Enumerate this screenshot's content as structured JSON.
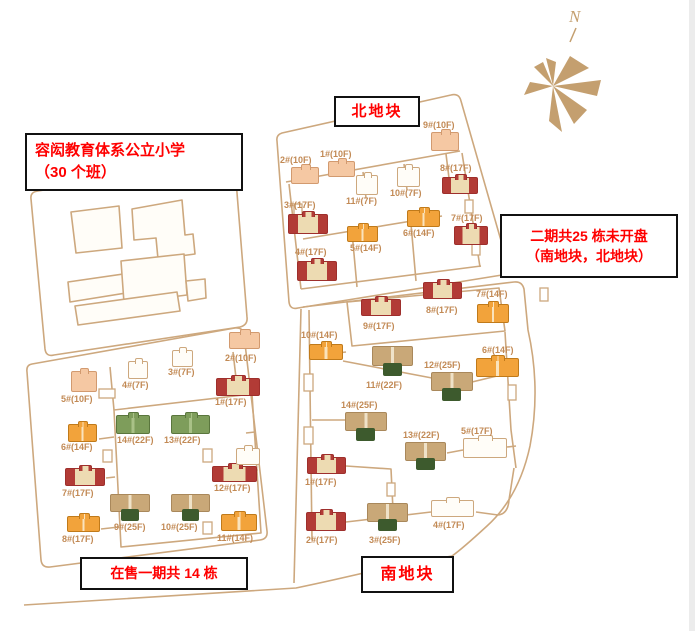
{
  "annotations": {
    "school_line1": "容闳教育体系公立小学",
    "school_line2": "（30 个班）",
    "north_plot": "北地块",
    "south_plot": "南地块",
    "phase1_status": "在售一期共 14 栋",
    "phase2_line1": "二期共25 栋未开盘",
    "phase2_line2": "（南地块，北地块）",
    "compass_n": "N"
  },
  "colors": {
    "vars": {
      "line": "#cda87e",
      "label": "#c28a55",
      "red_text": "#ff0000",
      "peach": "#f5c8a3",
      "peach_border": "#d29a6f",
      "red": "#b23b36",
      "cream": "#eddbb2",
      "orange": "#f2a33b",
      "green": "#7e9d5b",
      "tan": "#c9a878",
      "dark_green": "#3d5a2d",
      "compass": "#c49f6f"
    }
  },
  "buildings": {
    "north": [
      {
        "label": "1#(10F)",
        "type": "peach",
        "bx": 328,
        "by": 161,
        "bw": 27,
        "bh": 16,
        "lx": 320,
        "ly": 149
      },
      {
        "label": "2#(10F)",
        "type": "peach",
        "bx": 291,
        "by": 167,
        "bw": 28,
        "bh": 17,
        "lx": 280,
        "ly": 155
      },
      {
        "label": "3#(17F)",
        "type": "red",
        "bx": 288,
        "by": 214,
        "bw": 40,
        "bh": 20,
        "lx": 284,
        "ly": 200
      },
      {
        "label": "4#(17F)",
        "type": "red",
        "bx": 297,
        "by": 261,
        "bw": 40,
        "bh": 20,
        "lx": 295,
        "ly": 247
      },
      {
        "label": "5#(14F)",
        "type": "orange",
        "bx": 347,
        "by": 226,
        "bw": 31,
        "bh": 16,
        "lx": 350,
        "ly": 243
      },
      {
        "label": "6#(14F)",
        "type": "orange",
        "bx": 407,
        "by": 210,
        "bw": 33,
        "bh": 17,
        "lx": 403,
        "ly": 228
      },
      {
        "label": "7#(17F)",
        "type": "red",
        "bx": 454,
        "by": 226,
        "bw": 34,
        "bh": 19,
        "lx": 451,
        "ly": 213
      },
      {
        "label": "8#(17F)",
        "type": "red",
        "bx": 442,
        "by": 177,
        "bw": 36,
        "bh": 17,
        "lx": 440,
        "ly": 163
      },
      {
        "label": "9#(10F)",
        "type": "peach",
        "bx": 431,
        "by": 132,
        "bw": 28,
        "bh": 19,
        "lx": 423,
        "ly": 120
      },
      {
        "label": "10#(7F)",
        "type": "white",
        "bx": 397,
        "by": 167,
        "bw": 23,
        "bh": 20,
        "lx": 390,
        "ly": 188
      },
      {
        "label": "11#(7F)",
        "type": "white",
        "bx": 356,
        "by": 175,
        "bw": 22,
        "bh": 20,
        "lx": 346,
        "ly": 196
      }
    ],
    "phase1": [
      {
        "label": "1#(17F)",
        "type": "red",
        "bx": 216,
        "by": 378,
        "bw": 44,
        "bh": 18,
        "lx": 215,
        "ly": 397
      },
      {
        "label": "2#(10F)",
        "type": "peach",
        "bx": 229,
        "by": 332,
        "bw": 31,
        "bh": 17,
        "lx": 225,
        "ly": 353
      },
      {
        "label": "3#(7F)",
        "type": "white",
        "bx": 172,
        "by": 350,
        "bw": 21,
        "bh": 17,
        "lx": 168,
        "ly": 367
      },
      {
        "label": "4#(7F)",
        "type": "white",
        "bx": 128,
        "by": 361,
        "bw": 20,
        "bh": 18,
        "lx": 122,
        "ly": 380
      },
      {
        "label": "5#(10F)",
        "type": "peach",
        "bx": 71,
        "by": 371,
        "bw": 26,
        "bh": 21,
        "lx": 61,
        "ly": 394
      },
      {
        "label": "6#(14F)",
        "type": "orange",
        "bx": 68,
        "by": 424,
        "bw": 29,
        "bh": 18,
        "lx": 61,
        "ly": 442
      },
      {
        "label": "7#(17F)",
        "type": "red",
        "bx": 65,
        "by": 468,
        "bw": 40,
        "bh": 18,
        "lx": 62,
        "ly": 488
      },
      {
        "label": "8#(17F)",
        "type": "orange",
        "bx": 67,
        "by": 516,
        "bw": 33,
        "bh": 16,
        "lx": 62,
        "ly": 534
      },
      {
        "label": "9#(25F)",
        "type": "tan25",
        "bx": 110,
        "by": 494,
        "bw": 40,
        "bh": 27,
        "lx": 114,
        "ly": 522
      },
      {
        "label": "10#(25F)",
        "type": "tan25",
        "bx": 171,
        "by": 494,
        "bw": 39,
        "bh": 27,
        "lx": 161,
        "ly": 522
      },
      {
        "label": "11#(14F)",
        "type": "orange",
        "bx": 221,
        "by": 514,
        "bw": 36,
        "bh": 17,
        "lx": 217,
        "ly": 533
      },
      {
        "label": "12#(17F)",
        "type": "red",
        "bx": 212,
        "by": 466,
        "bw": 45,
        "bh": 16,
        "lx": 214,
        "ly": 483
      },
      {
        "label": "",
        "type": "white",
        "bx": 236,
        "by": 448,
        "bw": 24,
        "bh": 17,
        "lx": 0,
        "ly": 0
      },
      {
        "label": "13#(22F)",
        "type": "green",
        "bx": 171,
        "by": 415,
        "bw": 39,
        "bh": 19,
        "lx": 164,
        "ly": 435
      },
      {
        "label": "14#(22F)",
        "type": "green",
        "bx": 116,
        "by": 415,
        "bw": 34,
        "bh": 19,
        "lx": 117,
        "ly": 435
      }
    ],
    "south": [
      {
        "label": "1#(17F)",
        "type": "red",
        "bx": 307,
        "by": 457,
        "bw": 39,
        "bh": 17,
        "lx": 305,
        "ly": 477
      },
      {
        "label": "2#(17F)",
        "type": "red",
        "bx": 306,
        "by": 512,
        "bw": 40,
        "bh": 19,
        "lx": 306,
        "ly": 535
      },
      {
        "label": "3#(25F)",
        "type": "tan25",
        "bx": 367,
        "by": 503,
        "bw": 41,
        "bh": 28,
        "lx": 369,
        "ly": 535
      },
      {
        "label": "4#(17F)",
        "type": "white",
        "bx": 431,
        "by": 500,
        "bw": 43,
        "bh": 17,
        "lx": 433,
        "ly": 520
      },
      {
        "label": "5#(17F)",
        "type": "white",
        "bx": 463,
        "by": 438,
        "bw": 44,
        "bh": 20,
        "lx": 461,
        "ly": 426
      },
      {
        "label": "6#(14F)",
        "type": "orange",
        "bx": 476,
        "by": 358,
        "bw": 43,
        "bh": 19,
        "lx": 482,
        "ly": 345
      },
      {
        "label": "7#(14F)",
        "type": "orange",
        "bx": 477,
        "by": 304,
        "bw": 32,
        "bh": 19,
        "lx": 476,
        "ly": 289
      },
      {
        "label": "8#(17F)",
        "type": "red",
        "bx": 423,
        "by": 282,
        "bw": 39,
        "bh": 17,
        "lx": 426,
        "ly": 305
      },
      {
        "label": "9#(17F)",
        "type": "red",
        "bx": 361,
        "by": 299,
        "bw": 40,
        "bh": 17,
        "lx": 363,
        "ly": 321
      },
      {
        "label": "10#(14F)",
        "type": "orange",
        "bx": 309,
        "by": 344,
        "bw": 34,
        "bh": 16,
        "lx": 301,
        "ly": 330
      },
      {
        "label": "11#(22F)",
        "type": "tan25",
        "bx": 372,
        "by": 346,
        "bw": 41,
        "bh": 30,
        "lx": 366,
        "ly": 380
      },
      {
        "label": "12#(25F)",
        "type": "tan25",
        "bx": 431,
        "by": 372,
        "bw": 42,
        "bh": 29,
        "lx": 424,
        "ly": 360
      },
      {
        "label": "13#(22F)",
        "type": "tan25",
        "bx": 405,
        "by": 442,
        "bw": 41,
        "bh": 28,
        "lx": 403,
        "ly": 430
      },
      {
        "label": "14#(25F)",
        "type": "tan25",
        "bx": 345,
        "by": 412,
        "bw": 42,
        "bh": 29,
        "lx": 341,
        "ly": 400
      }
    ]
  }
}
